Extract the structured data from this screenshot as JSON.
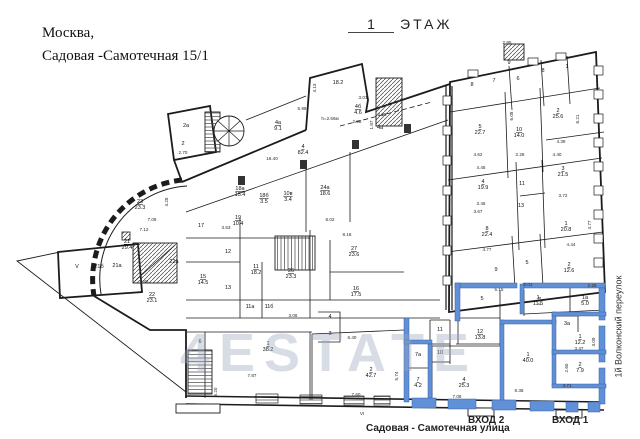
{
  "header": {
    "address_line1": "Москва,",
    "address_line2": "Садовая -Самотечная 15/1",
    "floor_number": "1",
    "floor_word": "ЭТАЖ"
  },
  "labels": {
    "street_bottom": "Садовая - Самотечная улица",
    "street_right": "1й Волконский переулок",
    "entrance_1": "ВХОД 1",
    "entrance_2": "ВХОД 2"
  },
  "watermark": "4ESTATE",
  "colors": {
    "highlight": "#5f90d8",
    "highlight_edge": "#39619f",
    "wall": "#1c1c1c",
    "dim_text": "#2a2a2a"
  },
  "plan": {
    "rooms": [
      {
        "n": "9",
        "x": 509,
        "y": 64
      },
      {
        "n": "8",
        "x": 472,
        "y": 86
      },
      {
        "n": "7",
        "x": 494,
        "y": 82
      },
      {
        "n": "6",
        "x": 518,
        "y": 80
      },
      {
        "n": "8",
        "x": 543,
        "y": 72
      },
      {
        "n": "1",
        "x": 567,
        "y": 68
      },
      {
        "n": "5",
        "a": "22.7",
        "x": 480,
        "y": 128
      },
      {
        "n": "10",
        "a": "14.0",
        "x": 519,
        "y": 131
      },
      {
        "n": "2",
        "a": "25.6",
        "x": 558,
        "y": 112
      },
      {
        "n": "4",
        "a": "19.9",
        "x": 483,
        "y": 183
      },
      {
        "n": "11",
        "x": 522,
        "y": 185
      },
      {
        "n": "13",
        "x": 521,
        "y": 207
      },
      {
        "n": "3",
        "a": "21.5",
        "x": 563,
        "y": 170
      },
      {
        "n": "8",
        "a": "22.4",
        "x": 487,
        "y": 230
      },
      {
        "n": "1",
        "a": "20.8",
        "x": 566,
        "y": 225
      },
      {
        "n": "9",
        "x": 496,
        "y": 271
      },
      {
        "n": "5",
        "x": 527,
        "y": 264
      },
      {
        "n": "2",
        "a": "12.6",
        "x": 569,
        "y": 266
      },
      {
        "n": "5",
        "x": 482,
        "y": 300
      },
      {
        "n": "12",
        "a": "13.8",
        "x": 480,
        "y": 333
      },
      {
        "n": "1",
        "a": "11.5",
        "x": 538,
        "y": 299
      },
      {
        "n": "1а",
        "a": "5.0",
        "x": 585,
        "y": 299
      },
      {
        "n": "3а",
        "x": 567,
        "y": 325
      },
      {
        "n": "1",
        "a": "12.2",
        "x": 580,
        "y": 338
      },
      {
        "n": "2",
        "a": "7.9",
        "x": 580,
        "y": 366
      },
      {
        "n": "1",
        "a": "40.0",
        "x": 528,
        "y": 356
      },
      {
        "n": "4",
        "a": "25.3",
        "x": 464,
        "y": 381
      },
      {
        "n": "7а",
        "x": 418,
        "y": 356
      },
      {
        "n": "7",
        "a": "4.2",
        "x": 418,
        "y": 381
      },
      {
        "n": "11",
        "x": 440,
        "y": 331
      },
      {
        "n": "10",
        "x": 440,
        "y": 354
      },
      {
        "n": "2",
        "a": "42.7",
        "x": 371,
        "y": 371
      },
      {
        "n": "1",
        "a": "38.2",
        "x": 268,
        "y": 345
      },
      {
        "n": "6",
        "x": 200,
        "y": 343
      },
      {
        "n": "3",
        "x": 330,
        "y": 335
      },
      {
        "n": "4",
        "x": 330,
        "y": 318
      },
      {
        "n": "17",
        "x": 201,
        "y": 227
      },
      {
        "n": "19",
        "a": "10.4",
        "x": 238,
        "y": 219
      },
      {
        "n": "12",
        "x": 228,
        "y": 253
      },
      {
        "n": "13",
        "x": 228,
        "y": 289
      },
      {
        "n": "15",
        "a": "14.5",
        "x": 203,
        "y": 278
      },
      {
        "n": "11",
        "a": "18.2",
        "x": 256,
        "y": 268
      },
      {
        "n": "26",
        "a": "23.3",
        "x": 291,
        "y": 272
      },
      {
        "n": "27",
        "a": "23.6",
        "x": 354,
        "y": 250
      },
      {
        "n": "16",
        "a": "17.5",
        "x": 356,
        "y": 290
      },
      {
        "n": "11а",
        "x": 250,
        "y": 308
      },
      {
        "n": "11б",
        "x": 269,
        "y": 308
      },
      {
        "n": "24а",
        "a": "18.6",
        "x": 325,
        "y": 189
      },
      {
        "n": "18а",
        "a": "15.4",
        "x": 240,
        "y": 190
      },
      {
        "n": "18б",
        "a": "3.5",
        "x": 264,
        "y": 197
      },
      {
        "n": "10в",
        "a": "3.4",
        "x": 288,
        "y": 195
      },
      {
        "n": "4",
        "a": "82.4",
        "x": 303,
        "y": 148
      },
      {
        "n": "4а",
        "a": "9.1",
        "x": 278,
        "y": 124
      },
      {
        "n": "4б",
        "a": "4.6",
        "x": 358,
        "y": 108
      },
      {
        "n": "4а",
        "x": 380,
        "y": 129
      },
      {
        "n": "2а",
        "x": 186,
        "y": 127
      },
      {
        "n": "2",
        "x": 183,
        "y": 145
      },
      {
        "n": "",
        "a": "18.2",
        "x": 338,
        "y": 84
      },
      {
        "n": "23",
        "a": "23.3",
        "x": 140,
        "y": 203
      },
      {
        "n": "21",
        "a": "29.4",
        "x": 127,
        "y": 243
      },
      {
        "n": "21а",
        "x": 117,
        "y": 267
      },
      {
        "n": "21б",
        "x": 99,
        "y": 268
      },
      {
        "n": "V",
        "x": 77,
        "y": 268
      },
      {
        "n": "22а",
        "x": 174,
        "y": 263
      },
      {
        "n": "22",
        "a": "23.1",
        "x": 152,
        "y": 296
      }
    ],
    "dimensions": [
      {
        "t": "16.40",
        "x": 272,
        "y": 160
      },
      {
        "t": "h=2.66м",
        "x": 330,
        "y": 120
      },
      {
        "t": "5.99",
        "x": 302,
        "y": 110
      },
      {
        "t": "2.95",
        "x": 507,
        "y": 44
      },
      {
        "t": "7.08",
        "x": 152,
        "y": 221
      },
      {
        "t": "7.12",
        "x": 144,
        "y": 231
      },
      {
        "t": "7.83",
        "x": 144,
        "y": 283
      },
      {
        "t": "4.28",
        "x": 168,
        "y": 202,
        "r": 1
      },
      {
        "t": "3.53",
        "x": 226,
        "y": 229
      },
      {
        "t": "8.02",
        "x": 330,
        "y": 221
      },
      {
        "t": "8.18",
        "x": 347,
        "y": 236
      },
      {
        "t": "4.13",
        "x": 316,
        "y": 88,
        "r": 1
      },
      {
        "t": "3.01",
        "x": 363,
        "y": 99
      },
      {
        "t": "2.98",
        "x": 357,
        "y": 123
      },
      {
        "t": "1.87",
        "x": 373,
        "y": 125,
        "r": 1
      },
      {
        "t": "2.35",
        "x": 382,
        "y": 116
      },
      {
        "t": "2.70",
        "x": 183,
        "y": 154
      },
      {
        "t": "3.46",
        "x": 481,
        "y": 205
      },
      {
        "t": "3.67",
        "x": 478,
        "y": 213
      },
      {
        "t": "4.62",
        "x": 478,
        "y": 156
      },
      {
        "t": "4.45",
        "x": 481,
        "y": 169
      },
      {
        "t": "2.28",
        "x": 520,
        "y": 156
      },
      {
        "t": "4.39",
        "x": 561,
        "y": 143
      },
      {
        "t": "4.40",
        "x": 557,
        "y": 156
      },
      {
        "t": "6.08",
        "x": 513,
        "y": 116,
        "r": 1
      },
      {
        "t": "6.21",
        "x": 579,
        "y": 119,
        "r": 1
      },
      {
        "t": "3.72",
        "x": 563,
        "y": 197
      },
      {
        "t": "4.44",
        "x": 571,
        "y": 246
      },
      {
        "t": "4.77",
        "x": 487,
        "y": 251
      },
      {
        "t": "4.77",
        "x": 591,
        "y": 225,
        "r": 1
      },
      {
        "t": "2.01",
        "x": 528,
        "y": 286
      },
      {
        "t": "5.15",
        "x": 499,
        "y": 291
      },
      {
        "t": "2.24",
        "x": 541,
        "y": 301,
        "r": 1
      },
      {
        "t": "2.25",
        "x": 592,
        "y": 287
      },
      {
        "t": "3.47",
        "x": 579,
        "y": 350
      },
      {
        "t": "3.09",
        "x": 595,
        "y": 342,
        "r": 1
      },
      {
        "t": "2.60",
        "x": 568,
        "y": 368,
        "r": 1
      },
      {
        "t": "3.71",
        "x": 567,
        "y": 387
      },
      {
        "t": "8.38",
        "x": 519,
        "y": 392
      },
      {
        "t": "7.08",
        "x": 457,
        "y": 398
      },
      {
        "t": "6.40",
        "x": 352,
        "y": 339
      },
      {
        "t": "3.06",
        "x": 293,
        "y": 317
      },
      {
        "t": "7.60",
        "x": 356,
        "y": 396
      },
      {
        "t": "5.74",
        "x": 398,
        "y": 376,
        "r": 1
      },
      {
        "t": "7.87",
        "x": 252,
        "y": 377
      },
      {
        "t": "5.20",
        "x": 217,
        "y": 392,
        "r": 1
      },
      {
        "t": "VI",
        "x": 362,
        "y": 415
      }
    ]
  }
}
